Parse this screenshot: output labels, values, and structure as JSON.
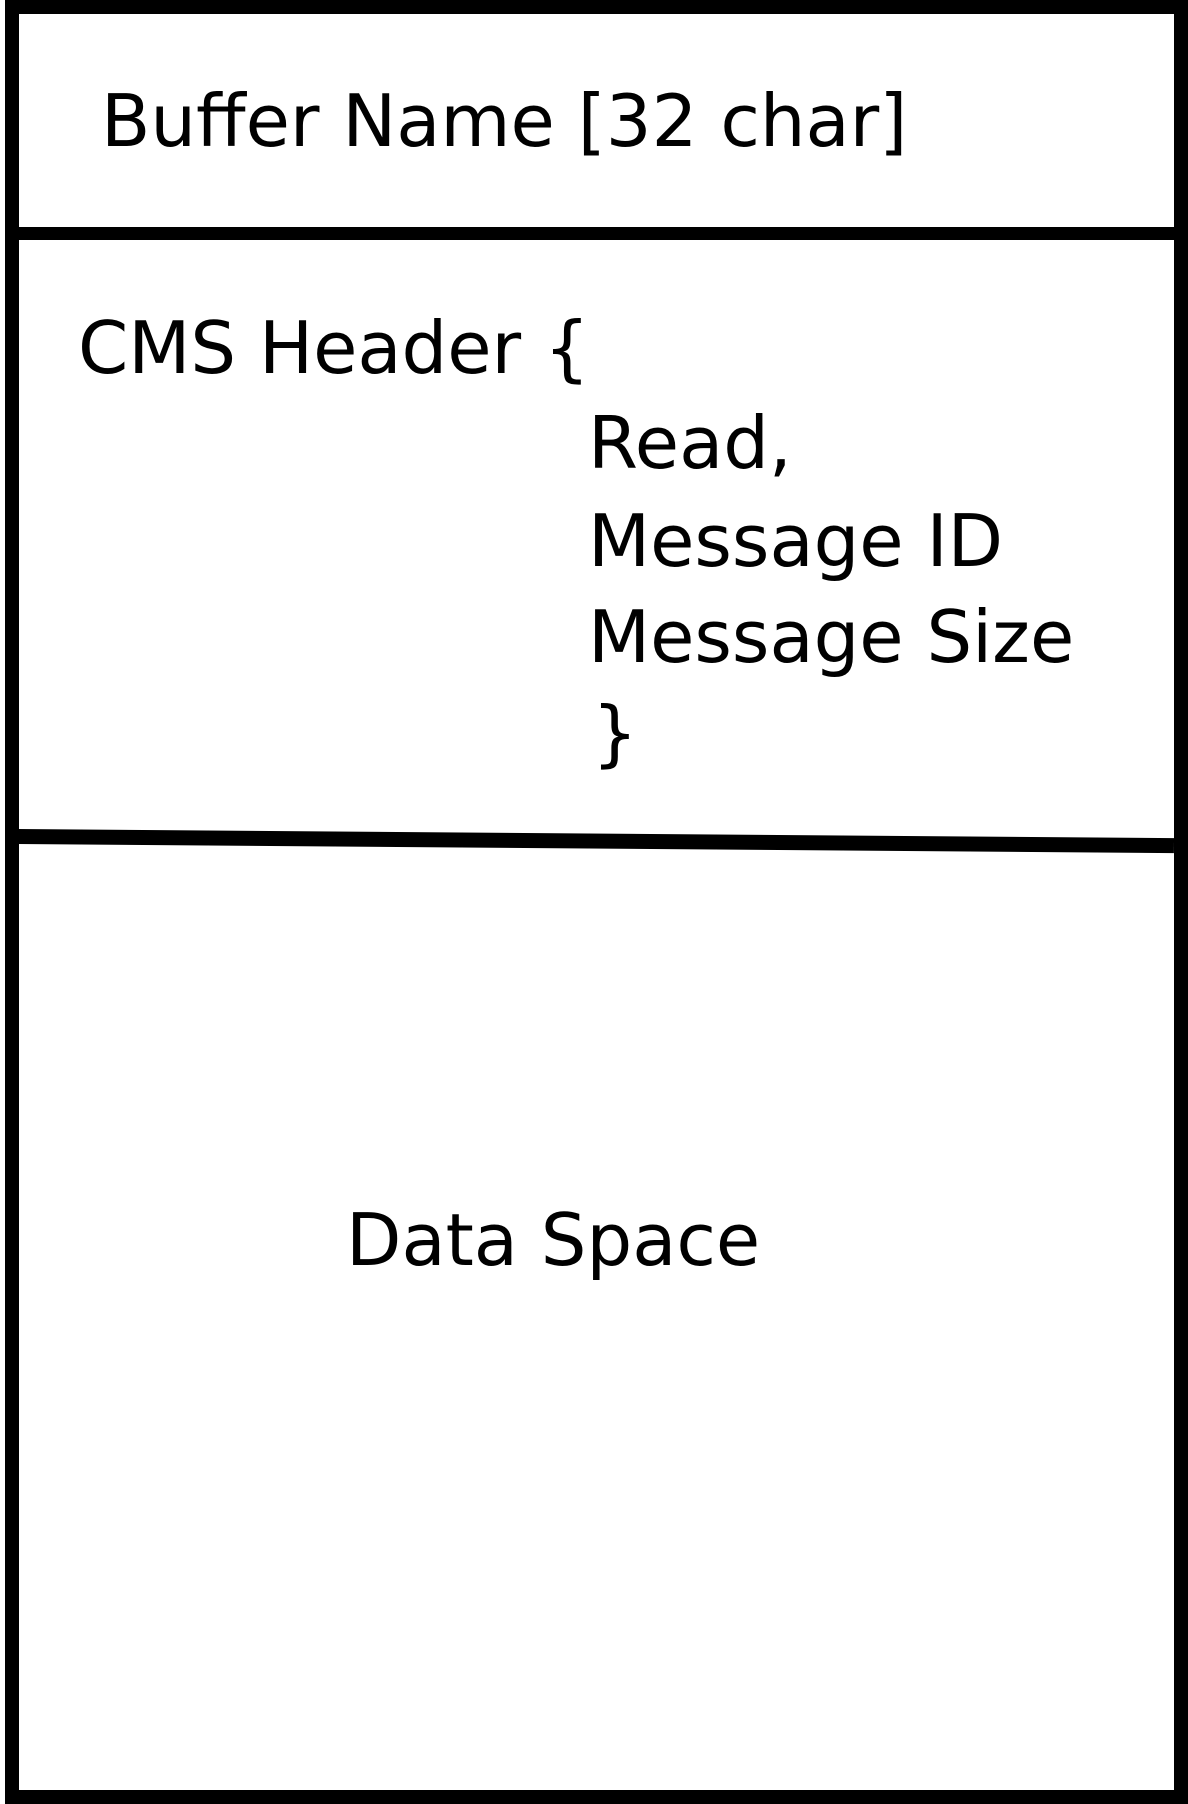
{
  "diagram": {
    "colors": {
      "background": "#ffffff",
      "line": "#000000",
      "text": "#000000"
    },
    "sections": {
      "buffer_name": {
        "label": "Buffer Name [32 char]"
      },
      "cms_header": {
        "open": "CMS Header {",
        "fields": [
          "Read,",
          "Message ID",
          "Message Size"
        ],
        "close": "}"
      },
      "data_space": {
        "label": "Data Space"
      }
    }
  }
}
